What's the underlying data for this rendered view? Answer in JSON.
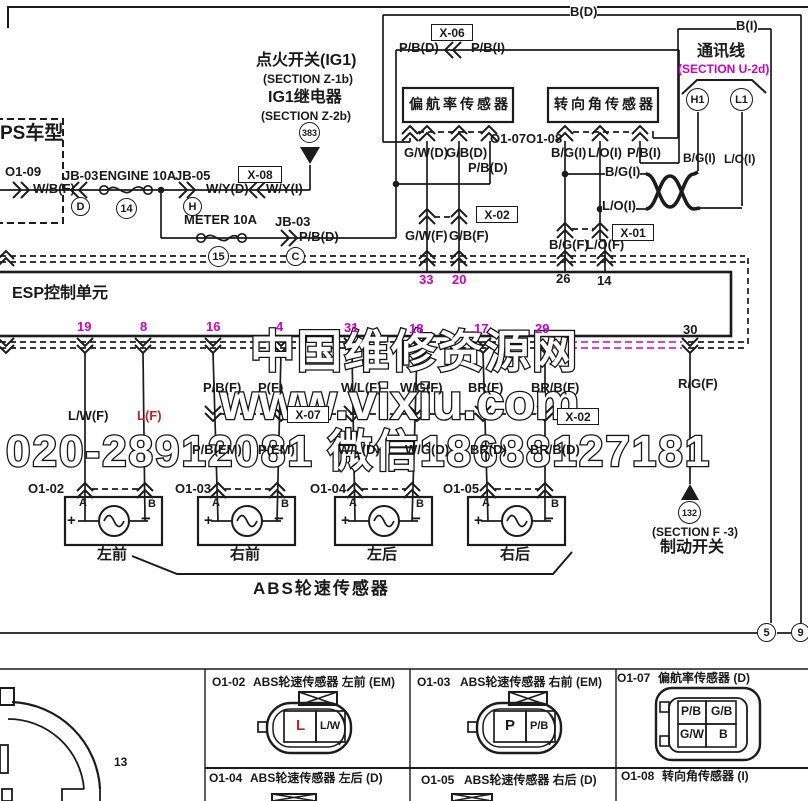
{
  "colors": {
    "magenta": "#CC00CC",
    "magenta_dash": "#E23BE2",
    "red": "#CC2020",
    "line": "#1a1a1a"
  },
  "watermark": {
    "site_name": "中国维修资源网",
    "url": "www.vixiu.com",
    "contact": "020-28912081 微信18688127181"
  },
  "labels": [
    {
      "n": "model-variant",
      "t": "PS车型",
      "x": 0,
      "y": 124,
      "fs": 19
    },
    {
      "n": "connector-ref-o1-09",
      "t": "O1-09",
      "x": 5,
      "y": 165
    },
    {
      "n": "wire-wb-f",
      "t": "W/B(F)",
      "x": 33,
      "y": 182
    },
    {
      "n": "junction-jb03-a",
      "t": "JB-03",
      "x": 63,
      "y": 169
    },
    {
      "n": "fuse-engine-10a",
      "t": "ENGINE 10A",
      "x": 99,
      "y": 169
    },
    {
      "n": "junction-jb05",
      "t": "JB-05",
      "x": 175,
      "y": 169
    },
    {
      "n": "wire-wy-d",
      "t": "W/Y(D)",
      "x": 206,
      "y": 182
    },
    {
      "n": "wire-wy-i",
      "t": "W/Y(I)",
      "x": 266,
      "y": 182
    },
    {
      "n": "ignition-switch-title",
      "t": "点火开关(IG1)",
      "x": 256,
      "y": 53,
      "fs": 16
    },
    {
      "n": "section-z1b",
      "t": "(SECTION Z-1b)",
      "x": 263,
      "y": 73,
      "fs": 12
    },
    {
      "n": "ig1-relay-title",
      "t": "IG1继电器",
      "x": 268,
      "y": 90,
      "fs": 16
    },
    {
      "n": "section-z2b",
      "t": "(SECTION Z-2b)",
      "x": 261,
      "y": 110,
      "fs": 12
    },
    {
      "n": "fuse-meter-10a",
      "t": "METER 10A",
      "x": 184,
      "y": 213
    },
    {
      "n": "junction-jb03-b",
      "t": "JB-03",
      "x": 275,
      "y": 215
    },
    {
      "n": "wire-pb-d-meter",
      "t": "P/B(D)",
      "x": 299,
      "y": 230
    },
    {
      "n": "wire-b-d-top",
      "t": "B(D)",
      "x": 570,
      "y": 5,
      "bg": 1
    },
    {
      "n": "wire-b-i-top",
      "t": "B(I)",
      "x": 736,
      "y": 19,
      "bg": 1
    },
    {
      "n": "wire-pb-d-x06",
      "t": "P/B(D)",
      "x": 399,
      "y": 41
    },
    {
      "n": "wire-pb-i-x06",
      "t": "P/B(I)",
      "x": 471,
      "y": 41
    },
    {
      "n": "comm-line-title",
      "t": "通讯线",
      "x": 697,
      "y": 44,
      "fs": 16
    },
    {
      "n": "section-u2d",
      "t": "(SECTION U-2d)",
      "x": 678,
      "y": 63,
      "fs": 12,
      "c": "magenta"
    },
    {
      "n": "yaw-sensor-title",
      "t": "偏航率传感器",
      "x": 409,
      "y": 97,
      "fs": 14,
      "ls": 3
    },
    {
      "n": "steer-sensor-title",
      "t": "转向角传感器",
      "x": 554,
      "y": 97,
      "fs": 14,
      "ls": 3
    },
    {
      "n": "connector-ref-o1-07",
      "t": "O1-07",
      "x": 490,
      "y": 132
    },
    {
      "n": "connector-ref-o1-08",
      "t": "O1-08",
      "x": 526,
      "y": 132
    },
    {
      "n": "wire-gw-d",
      "t": "G/W(D)",
      "x": 404,
      "y": 146
    },
    {
      "n": "wire-gb-d",
      "t": "G/B(D)",
      "x": 446,
      "y": 146
    },
    {
      "n": "wire-pb-d2",
      "t": "P/B(D)",
      "x": 468,
      "y": 161
    },
    {
      "n": "wire-bg-i",
      "t": "B/G(I)",
      "x": 551,
      "y": 146
    },
    {
      "n": "wire-lo-i",
      "t": "L/O(I)",
      "x": 588,
      "y": 146
    },
    {
      "n": "wire-pb-i2",
      "t": "P/B(I)",
      "x": 627,
      "y": 146
    },
    {
      "n": "wire-bg-i-branch",
      "t": "B/G(I)",
      "x": 605,
      "y": 165,
      "bg": 1
    },
    {
      "n": "wire-lo-i-branch",
      "t": "L/O(I)",
      "x": 602,
      "y": 199,
      "bg": 1
    },
    {
      "n": "wire-bg-i-leg",
      "t": "B/G(I)",
      "x": 683,
      "y": 152,
      "fs": 12
    },
    {
      "n": "wire-lo-i-leg",
      "t": "L/O(I)",
      "x": 724,
      "y": 153,
      "fs": 12
    },
    {
      "n": "wire-gw-f",
      "t": "G/W(F)",
      "x": 405,
      "y": 229
    },
    {
      "n": "wire-gb-f",
      "t": "G/B(F)",
      "x": 449,
      "y": 229
    },
    {
      "n": "wire-bg-f",
      "t": "B/G(F)",
      "x": 549,
      "y": 238
    },
    {
      "n": "wire-lo-f",
      "t": "L/O(F)",
      "x": 586,
      "y": 238
    },
    {
      "n": "esp-unit-title",
      "t": "ESP控制单元",
      "x": 12,
      "y": 286,
      "fs": 16
    },
    {
      "n": "pin-33",
      "t": "33",
      "x": 419,
      "y": 273,
      "c": "magenta"
    },
    {
      "n": "pin-20",
      "t": "20",
      "x": 452,
      "y": 273,
      "c": "magenta"
    },
    {
      "n": "pin-26",
      "t": "26",
      "x": 556,
      "y": 272
    },
    {
      "n": "pin-14",
      "t": "14",
      "x": 597,
      "y": 274
    },
    {
      "n": "pin-19",
      "t": "19",
      "x": 77,
      "y": 320,
      "c": "magenta"
    },
    {
      "n": "pin-8",
      "t": "8",
      "x": 140,
      "y": 320,
      "c": "magenta"
    },
    {
      "n": "pin-16",
      "t": "16",
      "x": 206,
      "y": 320,
      "c": "magenta"
    },
    {
      "n": "pin-4",
      "t": "4",
      "x": 276,
      "y": 320,
      "c": "magenta"
    },
    {
      "n": "pin-31",
      "t": "31",
      "x": 344,
      "y": 321,
      "c": "magenta"
    },
    {
      "n": "pin-18",
      "t": "18",
      "x": 409,
      "y": 322,
      "c": "magenta"
    },
    {
      "n": "pin-17",
      "t": "17",
      "x": 474,
      "y": 322,
      "c": "magenta"
    },
    {
      "n": "pin-29",
      "t": "29",
      "x": 535,
      "y": 322,
      "c": "magenta"
    },
    {
      "n": "pin-30",
      "t": "30",
      "x": 683,
      "y": 323
    },
    {
      "n": "wire-lw-f",
      "t": "L/W(F)",
      "x": 68,
      "y": 409
    },
    {
      "n": "wire-l-f",
      "t": "L(F)",
      "x": 137,
      "y": 409,
      "c": "red"
    },
    {
      "n": "wire-pb-f",
      "t": "P/B(F)",
      "x": 203,
      "y": 381
    },
    {
      "n": "wire-p-f",
      "t": "P(F)",
      "x": 258,
      "y": 381
    },
    {
      "n": "wire-wl-f",
      "t": "W/L(F)",
      "x": 341,
      "y": 381
    },
    {
      "n": "wire-wg-f",
      "t": "W/G(F)",
      "x": 400,
      "y": 381
    },
    {
      "n": "wire-br-f",
      "t": "BR(F)",
      "x": 468,
      "y": 381
    },
    {
      "n": "wire-brb-f",
      "t": "BR/B(F)",
      "x": 531,
      "y": 381
    },
    {
      "n": "wire-rg-f",
      "t": "R/G(F)",
      "x": 678,
      "y": 377
    },
    {
      "n": "wire-pb-em",
      "t": "P/B(EM)",
      "x": 192,
      "y": 443
    },
    {
      "n": "wire-p-em",
      "t": "P(EM)",
      "x": 258,
      "y": 443
    },
    {
      "n": "wire-wl-d",
      "t": "W/L(D)",
      "x": 338,
      "y": 443
    },
    {
      "n": "wire-wg-d",
      "t": "W/G(D)",
      "x": 405,
      "y": 443
    },
    {
      "n": "wire-br-d",
      "t": "BR(D)",
      "x": 470,
      "y": 443
    },
    {
      "n": "wire-brb-d",
      "t": "BR/B(D)",
      "x": 530,
      "y": 443
    },
    {
      "n": "connector-ref-o1-02",
      "t": "O1-02",
      "x": 28,
      "y": 482
    },
    {
      "n": "connector-ref-o1-03",
      "t": "O1-03",
      "x": 175,
      "y": 482
    },
    {
      "n": "connector-ref-o1-04",
      "t": "O1-04",
      "x": 310,
      "y": 482
    },
    {
      "n": "connector-ref-o1-05",
      "t": "O1-05",
      "x": 443,
      "y": 482
    },
    {
      "n": "pin-a1",
      "t": "A",
      "x": 79,
      "y": 498,
      "fs": 11
    },
    {
      "n": "pin-b1",
      "t": "B",
      "x": 148,
      "y": 499,
      "fs": 11
    },
    {
      "n": "pin-a2",
      "t": "A",
      "x": 212,
      "y": 498,
      "fs": 11
    },
    {
      "n": "pin-b2",
      "t": "B",
      "x": 281,
      "y": 499,
      "fs": 11
    },
    {
      "n": "pin-a3",
      "t": "A",
      "x": 349,
      "y": 498,
      "fs": 11
    },
    {
      "n": "pin-b3",
      "t": "B",
      "x": 416,
      "y": 499,
      "fs": 11
    },
    {
      "n": "pin-a4",
      "t": "A",
      "x": 482,
      "y": 498,
      "fs": 11
    },
    {
      "n": "pin-b4",
      "t": "B",
      "x": 551,
      "y": 499,
      "fs": 11
    },
    {
      "n": "plus-1",
      "t": "+",
      "x": 67,
      "y": 513,
      "fs": 15
    },
    {
      "n": "minus-1",
      "t": "−",
      "x": 141,
      "y": 510,
      "fs": 17
    },
    {
      "n": "plus-2",
      "t": "+",
      "x": 204,
      "y": 513,
      "fs": 15
    },
    {
      "n": "minus-2",
      "t": "−",
      "x": 274,
      "y": 510,
      "fs": 17
    },
    {
      "n": "plus-3",
      "t": "+",
      "x": 341,
      "y": 513,
      "fs": 15
    },
    {
      "n": "minus-3",
      "t": "−",
      "x": 411,
      "y": 510,
      "fs": 17
    },
    {
      "n": "plus-4",
      "t": "+",
      "x": 474,
      "y": 513,
      "fs": 15
    },
    {
      "n": "minus-4",
      "t": "−",
      "x": 544,
      "y": 510,
      "fs": 17
    },
    {
      "n": "sensor-front-left",
      "t": "左前",
      "x": 97,
      "y": 547,
      "fs": 15
    },
    {
      "n": "sensor-front-right",
      "t": "右前",
      "x": 230,
      "y": 547,
      "fs": 15
    },
    {
      "n": "sensor-rear-left",
      "t": "左后",
      "x": 367,
      "y": 547,
      "fs": 15
    },
    {
      "n": "sensor-rear-right",
      "t": "右后",
      "x": 500,
      "y": 547,
      "fs": 15
    },
    {
      "n": "abs-sensors-title",
      "t": "ABS轮速传感器",
      "x": 253,
      "y": 580,
      "fs": 17,
      "ls": 2
    },
    {
      "n": "section-f3",
      "t": "(SECTION F -3)",
      "x": 652,
      "y": 526,
      "fs": 12
    },
    {
      "n": "brake-switch-title",
      "t": "制动开关",
      "x": 660,
      "y": 540,
      "fs": 16
    },
    {
      "n": "connector-13",
      "t": "13",
      "x": 114,
      "y": 756,
      "fs": 12
    },
    {
      "n": "tbl-o1-02",
      "t": "O1-02",
      "x": 212,
      "y": 676,
      "fs": 12
    },
    {
      "n": "tbl-o1-02-desc",
      "t": "ABS轮速传感器 左前 (EM)",
      "x": 253,
      "y": 676,
      "fs": 12
    },
    {
      "n": "tbl-o1-03",
      "t": "O1-03",
      "x": 417,
      "y": 676,
      "fs": 12
    },
    {
      "n": "tbl-o1-03-desc",
      "t": "ABS轮速传感器 右前 (EM)",
      "x": 460,
      "y": 676,
      "fs": 12
    },
    {
      "n": "tbl-o1-07",
      "t": "O1-07",
      "x": 617,
      "y": 672,
      "fs": 12
    },
    {
      "n": "tbl-o1-07-desc",
      "t": "偏航率传感器 (D)",
      "x": 658,
      "y": 672,
      "fs": 12
    },
    {
      "n": "tbl-o1-04",
      "t": "O1-04",
      "x": 209,
      "y": 772,
      "fs": 12
    },
    {
      "n": "tbl-o1-04-desc",
      "t": "ABS轮速传感器 左后 (D)",
      "x": 250,
      "y": 772,
      "fs": 12
    },
    {
      "n": "tbl-o1-05",
      "t": "O1-05",
      "x": 421,
      "y": 774,
      "fs": 12
    },
    {
      "n": "tbl-o1-05-desc",
      "t": "ABS轮速传感器 右后 (D)",
      "x": 464,
      "y": 774,
      "fs": 12
    },
    {
      "n": "tbl-o1-08",
      "t": "O1-08",
      "x": 621,
      "y": 770,
      "fs": 12
    },
    {
      "n": "tbl-o1-08-desc",
      "t": "转向角传感器 (I)",
      "x": 662,
      "y": 770,
      "fs": 12
    },
    {
      "n": "conn-pin-l",
      "t": "L",
      "x": 296,
      "y": 718,
      "fs": 15,
      "c": "red"
    },
    {
      "n": "conn-pin-lw",
      "t": "L/W",
      "x": 320,
      "y": 721,
      "fs": 11
    },
    {
      "n": "conn-pin-p",
      "t": "P",
      "x": 505,
      "y": 718,
      "fs": 15
    },
    {
      "n": "conn-pin-pb",
      "t": "P/B",
      "x": 530,
      "y": 721,
      "fs": 11
    },
    {
      "n": "conn-pin-pb2",
      "t": "P/B",
      "x": 681,
      "y": 705,
      "fs": 12
    },
    {
      "n": "conn-pin-gb",
      "t": "G/B",
      "x": 711,
      "y": 705,
      "fs": 12
    },
    {
      "n": "conn-pin-gw",
      "t": "G/W",
      "x": 680,
      "y": 728,
      "fs": 12
    },
    {
      "n": "conn-pin-b",
      "t": "B",
      "x": 719,
      "y": 728,
      "fs": 12
    }
  ],
  "circle_refs": [
    {
      "n": "splice-d",
      "t": "D",
      "x": 81,
      "y": 207,
      "r": 10
    },
    {
      "n": "fuse-no-14",
      "t": "14",
      "x": 127,
      "y": 209,
      "r": 11
    },
    {
      "n": "splice-h",
      "t": "H",
      "x": 193,
      "y": 207,
      "r": 10
    },
    {
      "n": "fuse-no-15",
      "t": "15",
      "x": 219,
      "y": 257,
      "r": 11
    },
    {
      "n": "splice-c",
      "t": "C",
      "x": 296,
      "y": 257,
      "r": 10
    },
    {
      "n": "page-ref-383",
      "t": "383",
      "x": 310,
      "y": 133,
      "r": 11,
      "fs": 9
    },
    {
      "n": "can-high-h1",
      "t": "H1",
      "x": 698,
      "y": 100,
      "r": 12
    },
    {
      "n": "can-low-l1",
      "t": "L1",
      "x": 742,
      "y": 100,
      "r": 12
    },
    {
      "n": "page-ref-132",
      "t": "132",
      "x": 690,
      "y": 513,
      "r": 12,
      "fs": 9
    },
    {
      "n": "page-ref-5",
      "t": "5",
      "x": 767,
      "y": 633,
      "r": 10
    },
    {
      "n": "page-ref-9",
      "t": "9",
      "x": 801,
      "y": 633,
      "r": 10
    }
  ],
  "connector_boxes": [
    {
      "n": "connector-x08",
      "t": "X-08",
      "x": 238,
      "y": 166,
      "w": 42
    },
    {
      "n": "connector-x06",
      "t": "X-06",
      "x": 431,
      "y": 24,
      "w": 40
    },
    {
      "n": "connector-x02-top",
      "t": "X-02",
      "x": 476,
      "y": 206,
      "w": 40
    },
    {
      "n": "connector-x01",
      "t": "X-01",
      "x": 612,
      "y": 224,
      "w": 40
    },
    {
      "n": "connector-x07",
      "t": "X-07",
      "x": 287,
      "y": 406,
      "w": 40
    },
    {
      "n": "connector-x02-bottom",
      "t": "X-02",
      "x": 557,
      "y": 408,
      "w": 40
    }
  ]
}
